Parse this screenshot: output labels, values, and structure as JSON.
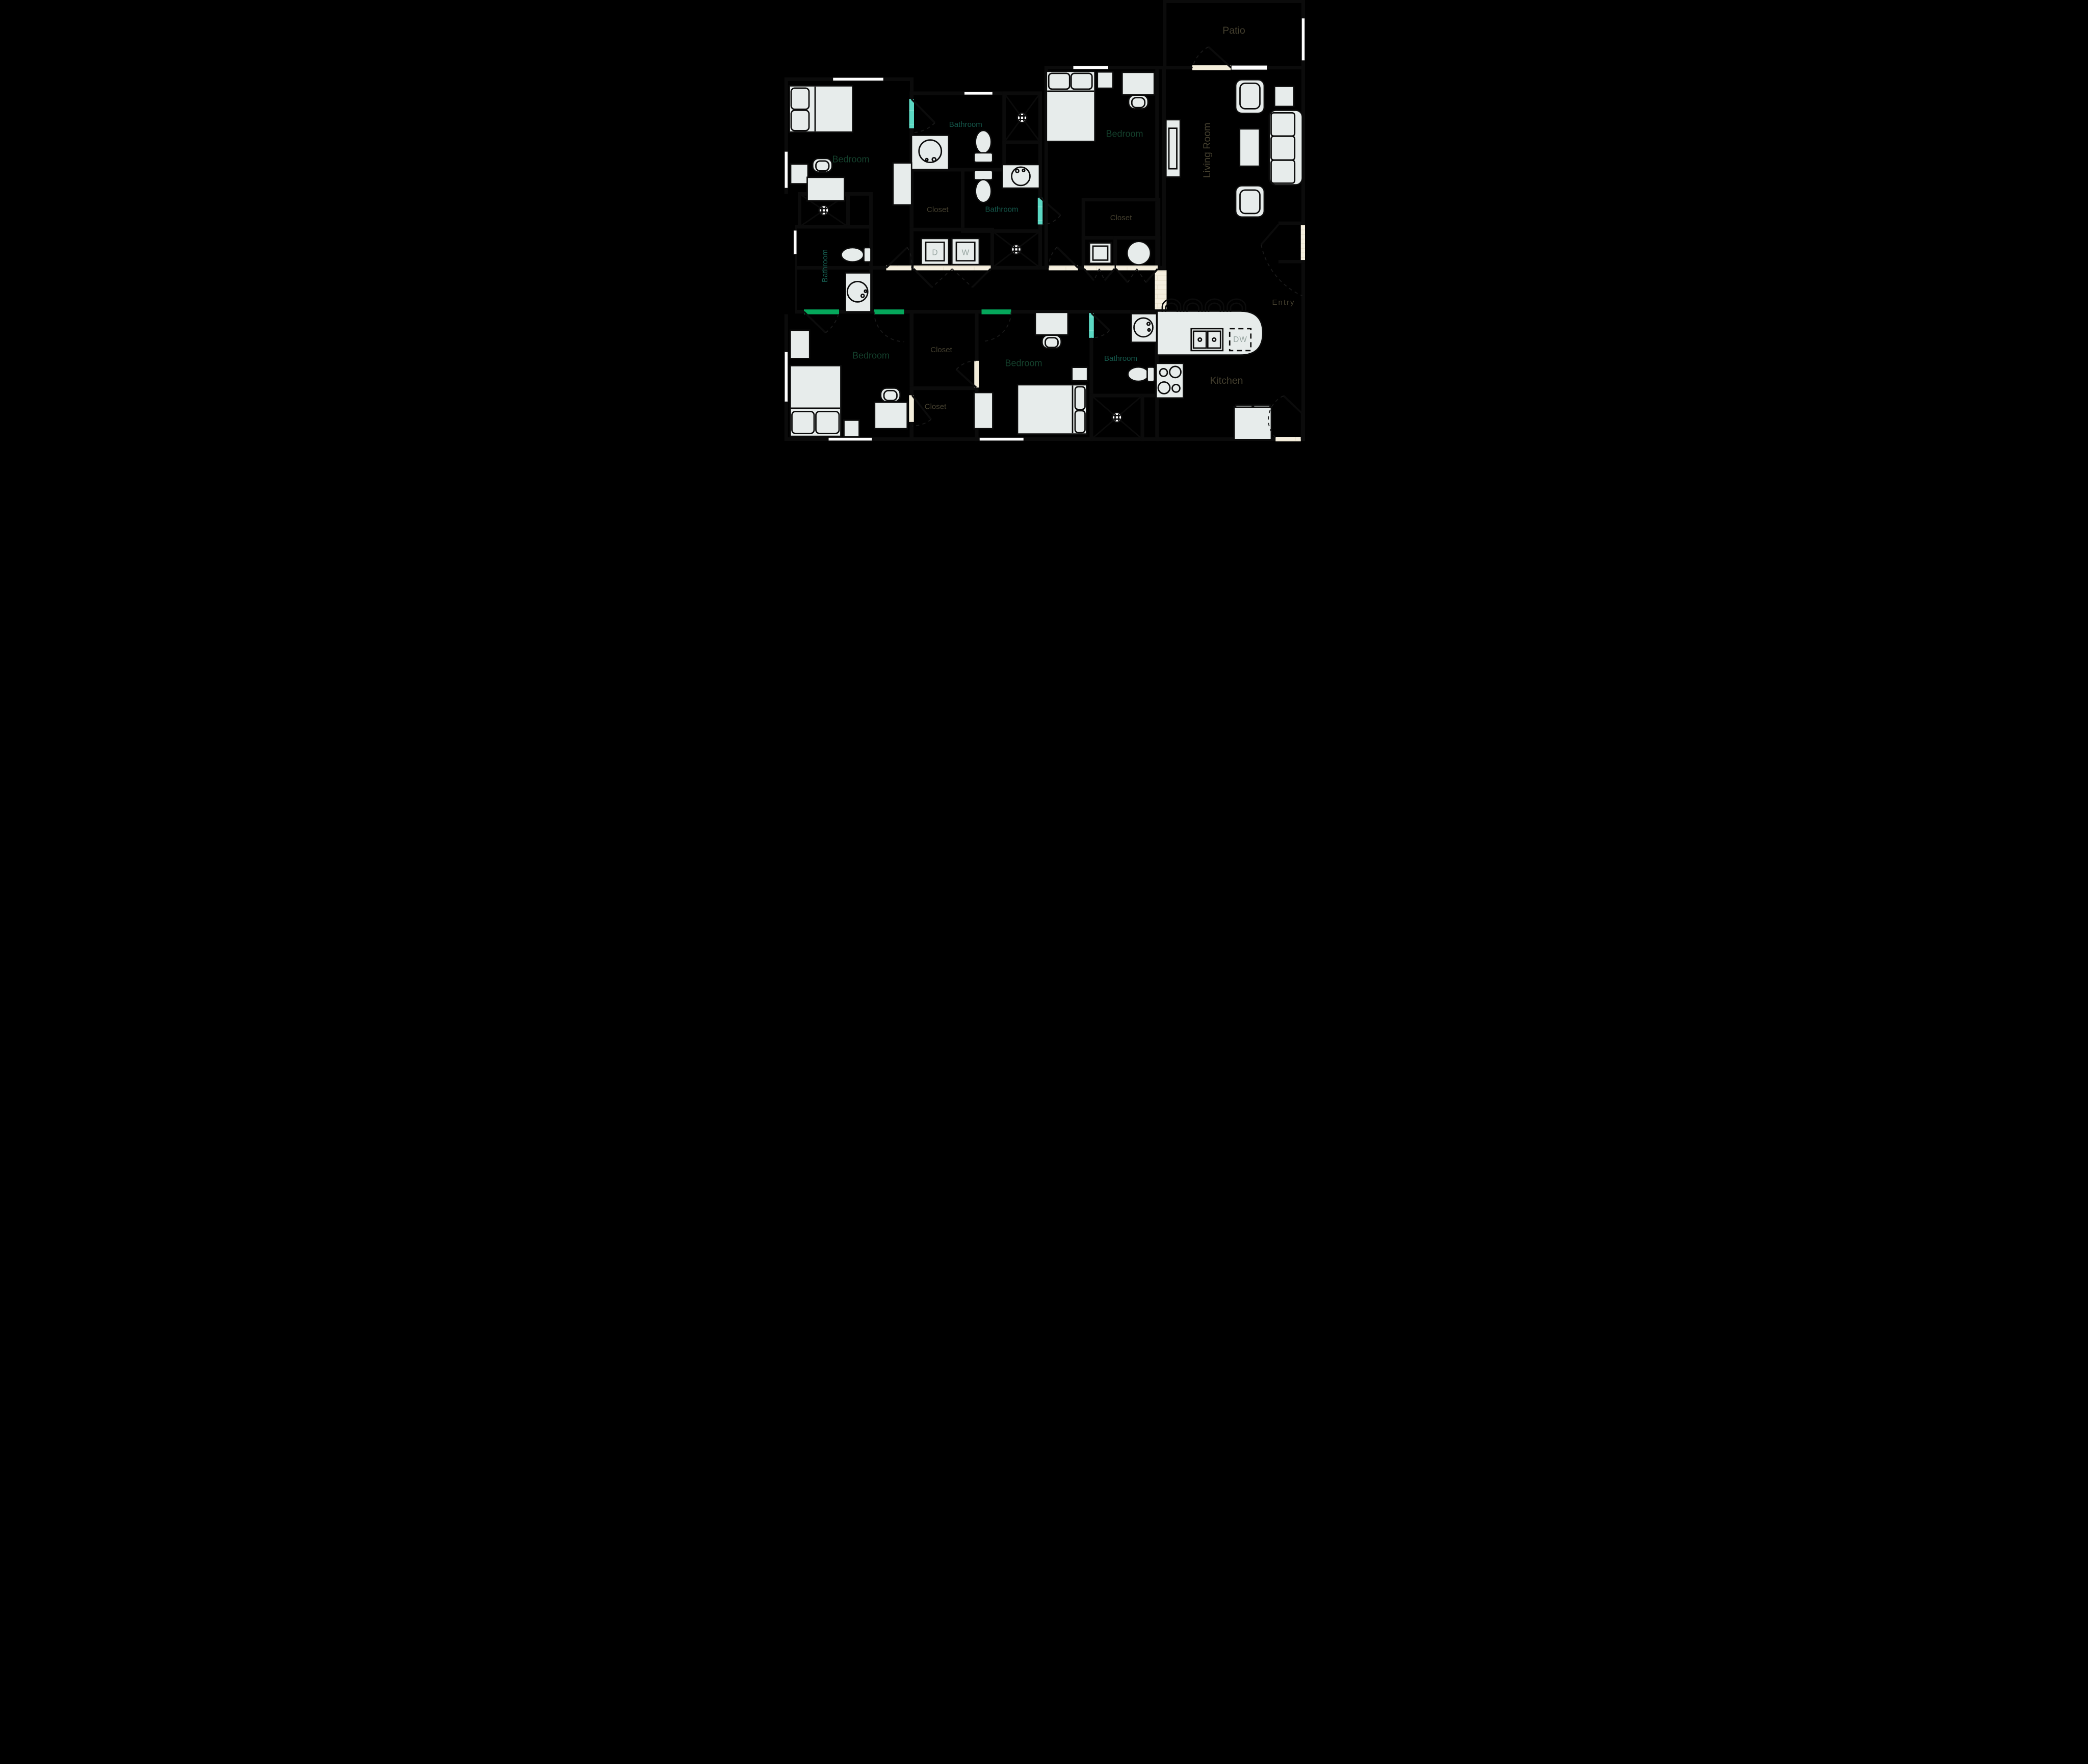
{
  "floorplan": {
    "type": "apartment-floor-plan",
    "labels": [
      {
        "id": "patio",
        "text": "Patio"
      },
      {
        "id": "bedroom-top-left",
        "text": "Bedroom"
      },
      {
        "id": "bathroom-top",
        "text": "Bathroom"
      },
      {
        "id": "bedroom-top-right",
        "text": "Bedroom"
      },
      {
        "id": "living-room",
        "text": "Living Room",
        "rotated": true
      },
      {
        "id": "closet-top-left",
        "text": "Closet"
      },
      {
        "id": "bathroom-middle",
        "text": "Bathroom"
      },
      {
        "id": "closet-top-right",
        "text": "Closet"
      },
      {
        "id": "bathroom-left",
        "text": "Bathroom",
        "rotated": true
      },
      {
        "id": "entry",
        "text": "Entry"
      },
      {
        "id": "closet-bottom-upper",
        "text": "Closet"
      },
      {
        "id": "bedroom-bottom-left",
        "text": "Bedroom"
      },
      {
        "id": "bedroom-bottom-middle",
        "text": "Bedroom"
      },
      {
        "id": "bathroom-bottom",
        "text": "Bathroom"
      },
      {
        "id": "kitchen",
        "text": "Kitchen"
      },
      {
        "id": "closet-bottom-lower",
        "text": "Closet"
      },
      {
        "id": "dryer",
        "text": "D"
      },
      {
        "id": "washer",
        "text": "W"
      },
      {
        "id": "dishwasher",
        "text": "DW"
      }
    ],
    "room_summary": {
      "bedrooms": 4,
      "bathrooms": 4,
      "closets": 4
    },
    "colors": {
      "bedroom_green": "#05a75b",
      "bathroom_teal": "#5bd8c3",
      "floor_cream": "#f3edda",
      "brick_line": "#e8e1cb",
      "wall_black": "#0b0b0b",
      "furniture_gray": "#e7eceb",
      "appliance_letter_gray": "#97a5a1"
    }
  }
}
